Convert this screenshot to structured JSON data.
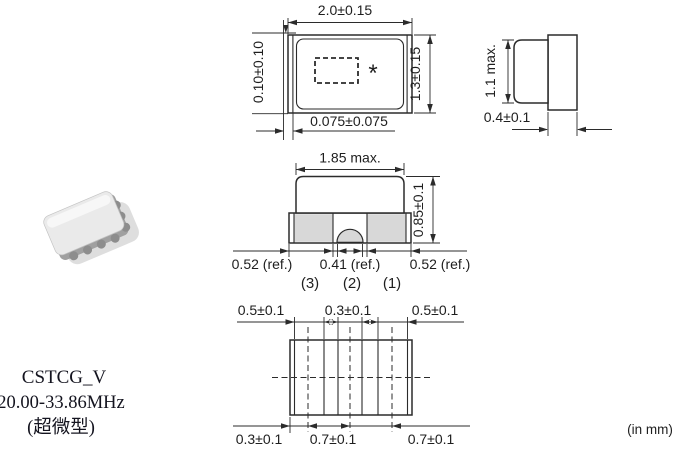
{
  "title_block": {
    "series": "CSTCG_V",
    "frequency_range": "20.00-33.86MHz",
    "size_note": "(超微型)"
  },
  "unit_note": "(in mm)",
  "top_view": {
    "width": "2.0±0.15",
    "height": "1.3±0.15",
    "edge_gap": "0.10±0.10",
    "terminal_offset": "0.075±0.075",
    "marking_symbol": "*"
  },
  "side_view": {
    "height": "1.1 max.",
    "substrate_thickness": "0.4±0.1"
  },
  "front_view": {
    "cap_width": "1.85 max.",
    "height": "0.85±0.1",
    "terminal_left": "0.52 (ref.)",
    "terminal_center": "0.41 (ref.)",
    "terminal_right": "0.52 (ref.)",
    "pins": [
      "(3)",
      "(2)",
      "(1)"
    ]
  },
  "bottom_view": {
    "top_dims": [
      "0.5±0.1",
      "0.3±0.1",
      "0.5±0.1"
    ],
    "bottom_dims": [
      "0.3±0.1",
      "0.7±0.1",
      "0.7±0.1"
    ]
  },
  "colors": {
    "line": "#2b2b2b",
    "terminal_fill": "#d8d8d8"
  }
}
